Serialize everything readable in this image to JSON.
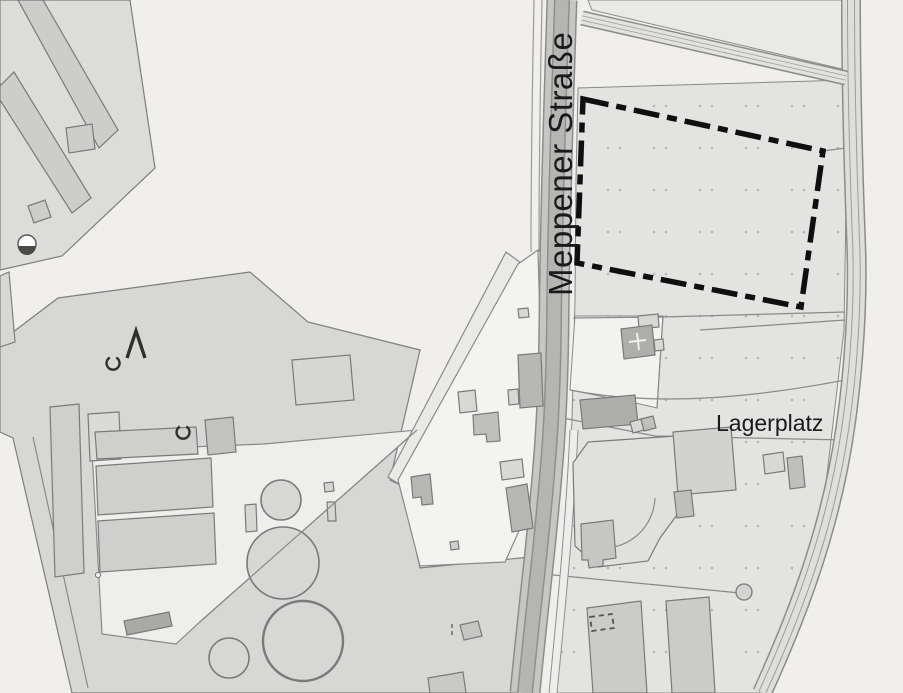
{
  "map": {
    "street_label": "Meppener Straße",
    "area_label": "Lagerplatz",
    "colors": {
      "background": "#f0efed",
      "parcel_light": "#e3e3e1",
      "parcel_white": "#f3f3f1",
      "yard_gray": "#d7d7d5",
      "building_light": "#d2d2d0",
      "building_dark": "#b2b2b0",
      "road_fill": "#c6c6c4",
      "road_core": "#b5b5b3",
      "outline": "#7e7e7e",
      "plan_boundary": "#0f0f0f",
      "label_text": "#1a1a1a"
    },
    "symbols": {
      "plan_boundary": "dash-dot-rectangle",
      "survey_marker": "half-filled-circle",
      "tree_marks": [
        "open-circle",
        "open-circle",
        "caret"
      ]
    }
  }
}
